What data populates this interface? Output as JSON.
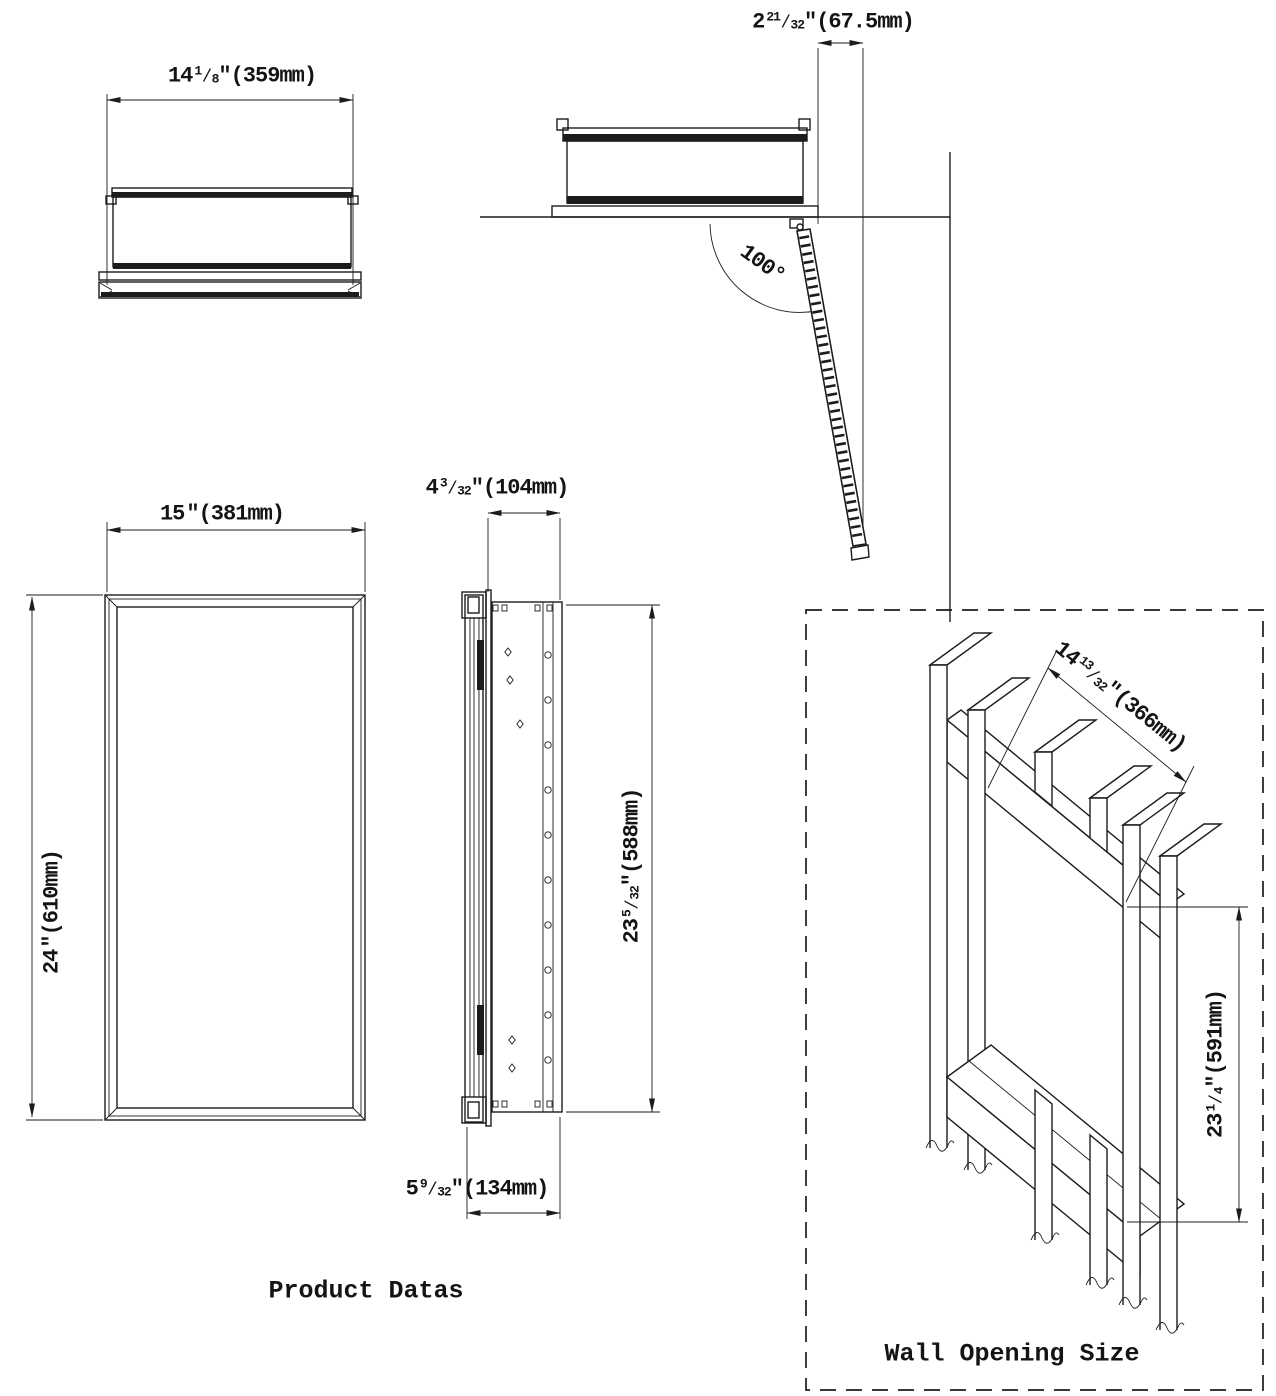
{
  "page": {
    "background": "#ffffff",
    "line_color": "#1c1c1c"
  },
  "labels": {
    "product": "Product Datas",
    "wall": "Wall Opening Size"
  },
  "dims": {
    "d359": {
      "whole": "14",
      "num": "1",
      "den": "8",
      "slash": "⁄",
      "inch": "″",
      "mm": "(359mm)"
    },
    "d675": {
      "whole": "2",
      "num": "21",
      "den": "32",
      "slash": "⁄",
      "inch": "″",
      "mm": "(67.5mm)"
    },
    "d381": {
      "whole": "15",
      "inch": "″",
      "mm": "(381mm)"
    },
    "d610": {
      "whole": "24",
      "inch": "″",
      "mm": "(610mm)"
    },
    "d104": {
      "whole": "4",
      "num": "3",
      "den": "32",
      "slash": "⁄",
      "inch": "″",
      "mm": "(104mm)"
    },
    "d588": {
      "whole": "23",
      "num": "5",
      "den": "32",
      "slash": "⁄",
      "inch": "″",
      "mm": "(588mm)"
    },
    "d134": {
      "whole": "5",
      "num": "9",
      "den": "32",
      "slash": "⁄",
      "inch": "″",
      "mm": "(134mm)"
    },
    "d366": {
      "whole": "14",
      "num": "13",
      "den": "32",
      "slash": "⁄",
      "inch": "″",
      "mm": "(366mm)"
    },
    "d591": {
      "whole": "23",
      "num": "1",
      "den": "4",
      "slash": "⁄",
      "inch": "″",
      "mm": "(591mm)"
    },
    "angle": "100°"
  }
}
